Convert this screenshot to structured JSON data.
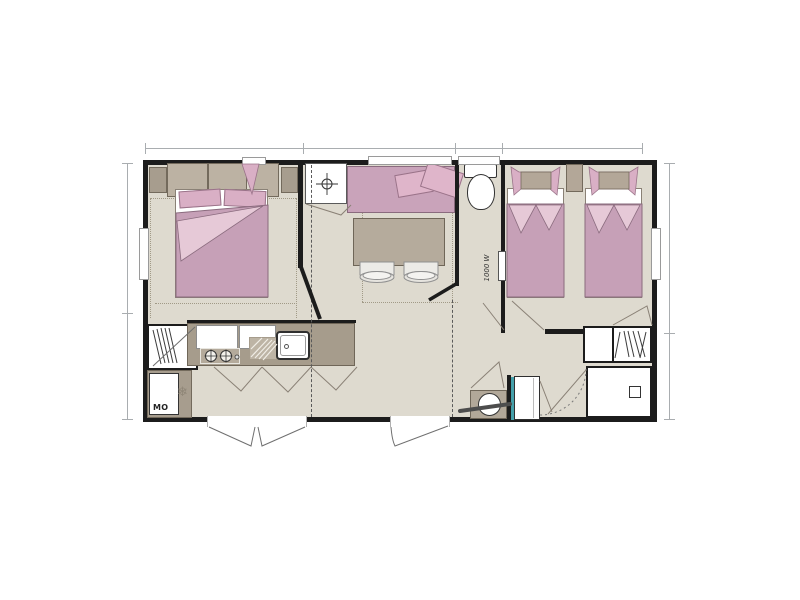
{
  "labels": {
    "microwave": "MO",
    "radiator_power": "1000 W"
  },
  "icons": {
    "freezer": "❄"
  },
  "colors": {
    "floor": "#dedacf",
    "wall": "#1c1c1c",
    "bedding_pink": "#c6a0b7",
    "bedding_pink_light": "#e6c9d7",
    "pillow_pink": "#d9afc5",
    "sofa_pink": "#c9a3ba",
    "furniture_taupe": "#b5ab9c",
    "counter_taupe": "#a69c8c",
    "cabinet_taupe": "#bcb2a3",
    "accent_teal": "#44a0aa",
    "dimension_line": "#a9adb0"
  }
}
